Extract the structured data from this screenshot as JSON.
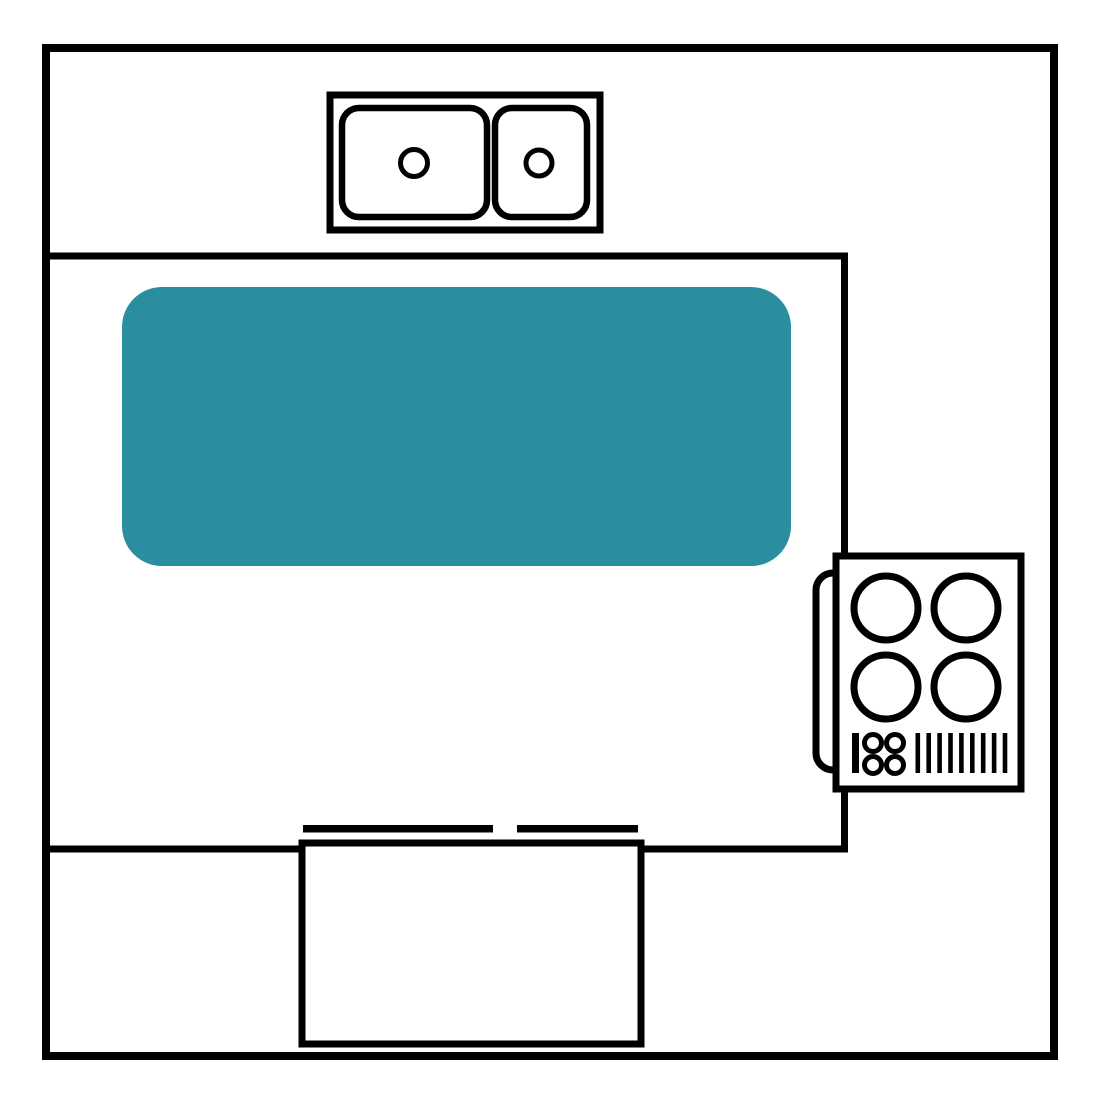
{
  "scene": {
    "type": "kitchen-floor-plan-diagram",
    "colors": {
      "background": "#ffffff",
      "line": "#000000",
      "fixture_fill": "#ffffff",
      "island_fill": "#2b8e9f"
    },
    "room": {
      "shape": "square-outline",
      "counter_layout": "U-shaped-counter-open-right"
    },
    "sink_unit": {
      "basin_count": 2,
      "drain_count": 2
    },
    "island": {
      "shape": "rounded-rectangle"
    },
    "cooktop": {
      "burner_count": 4,
      "knob_count": 4,
      "vent_slat_count": 9,
      "control_bar_count": 1
    },
    "dishwasher": {
      "door_dash_count": 2
    }
  }
}
